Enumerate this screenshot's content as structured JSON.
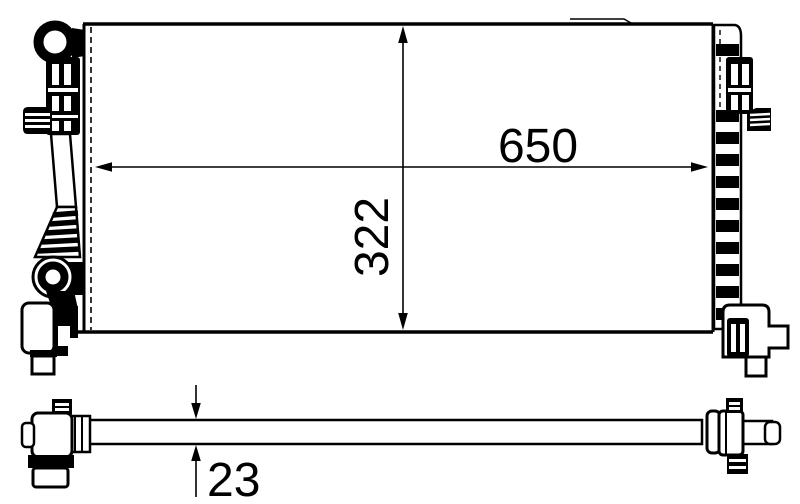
{
  "diagram": {
    "dimension_labels": {
      "width": "650",
      "height": "322",
      "thickness": "23"
    },
    "colors": {
      "line": "#000000",
      "background": "#ffffff"
    }
  }
}
